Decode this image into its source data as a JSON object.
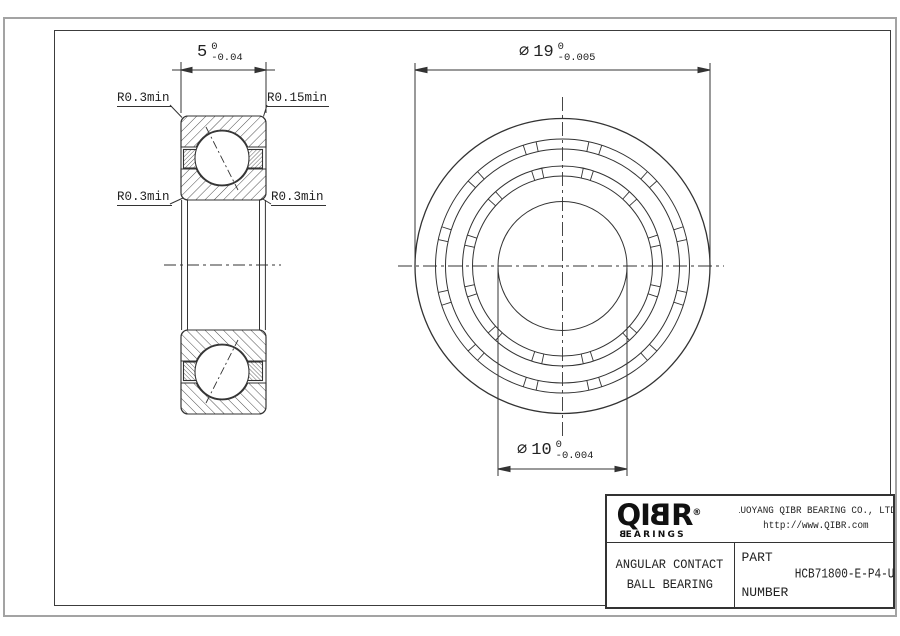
{
  "drawing": {
    "dimensions": {
      "width": {
        "value": "5",
        "tol_upper": "0",
        "tol_lower": "-0.04"
      },
      "outer_diameter": {
        "symbol": "⌀",
        "value": "19",
        "tol_upper": "0",
        "tol_lower": "-0.005"
      },
      "bore_diameter": {
        "symbol": "⌀",
        "value": "10",
        "tol_upper": "0",
        "tol_lower": "-0.004"
      }
    },
    "radius_labels": {
      "top_left": "R0.3min",
      "top_right": "R0.15min",
      "bottom_left": "R0.3min",
      "bottom_right": "R0.3min"
    },
    "front_view": {
      "cx": 562.5,
      "cy": 266,
      "radii": [
        147.5,
        127,
        117,
        100,
        90,
        64.5
      ],
      "pocket_bands": [
        {
          "r_inner": 117,
          "r_outer": 127
        },
        {
          "r_inner": 90,
          "r_outer": 100
        }
      ],
      "pocket_count": 12,
      "pocket_half_angle_deg": 12
    }
  },
  "title_block": {
    "logo": {
      "name_pre": "QI",
      "name_flip": "B",
      "name_post": "R",
      "registered": "®",
      "tagline_flip": "B",
      "tagline_rest": "EARINGS"
    },
    "company": "LUOYANG QIBR BEARING CO., LTD",
    "website": "http://www.QIBR.com",
    "product_line1": "ANGULAR CONTACT",
    "product_line2": "BALL BEARING",
    "part_label_line1": "PART",
    "part_label_line2": "NUMBER",
    "part_number": "HCB71800-E-P4-U"
  },
  "colors": {
    "line": "#333333",
    "frame": "#3c3c3c",
    "outer_border": "#a3a3a3",
    "background": "#ffffff"
  }
}
